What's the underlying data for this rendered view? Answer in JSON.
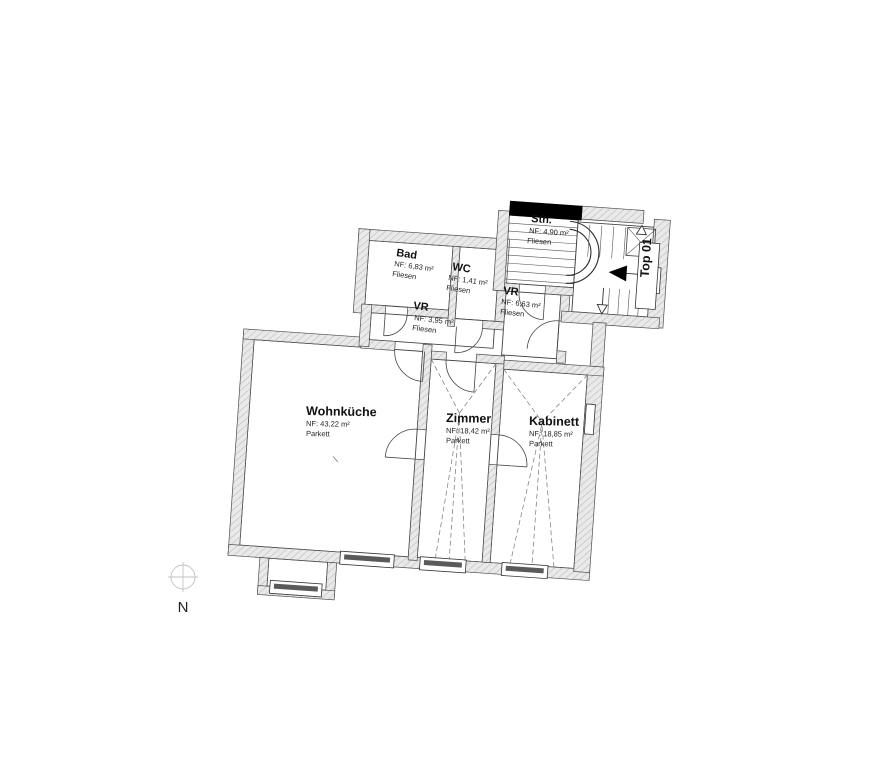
{
  "plan": {
    "rooms": [
      {
        "id": "wohnkueche",
        "name": "Wohnküche",
        "area": "NF: 43,22 m²",
        "floor": "Parkett"
      },
      {
        "id": "zimmer",
        "name": "Zimmer",
        "area": "NF: 18,42 m²",
        "floor": "Parkett"
      },
      {
        "id": "kabinett",
        "name": "Kabinett",
        "area": "NF: 18,85 m²",
        "floor": "Parkett"
      },
      {
        "id": "bad",
        "name": "Bad",
        "area": "NF: 6,83 m²",
        "floor": "Fliesen"
      },
      {
        "id": "wc",
        "name": "WC",
        "area": "NF: 1,41 m²",
        "floor": "Fliesen"
      },
      {
        "id": "vr-klein",
        "name": "VR",
        "area": "NF: 3,95 m²",
        "floor": "Fliesen"
      },
      {
        "id": "vr-gross",
        "name": "VR",
        "area": "NF: 6,63 m²",
        "floor": "Fliesen"
      },
      {
        "id": "stiegenhaus",
        "name": "Sth.",
        "area": "NF: 4,90 m²",
        "floor": "Fliesen"
      }
    ],
    "unit_label": "Top 01",
    "north_label": "N",
    "colors": {
      "wall_fill": "#e9e9e9",
      "wall_hatch": "#b8b8b8",
      "line": "#4d4d4d",
      "accent_black": "#000000"
    }
  }
}
